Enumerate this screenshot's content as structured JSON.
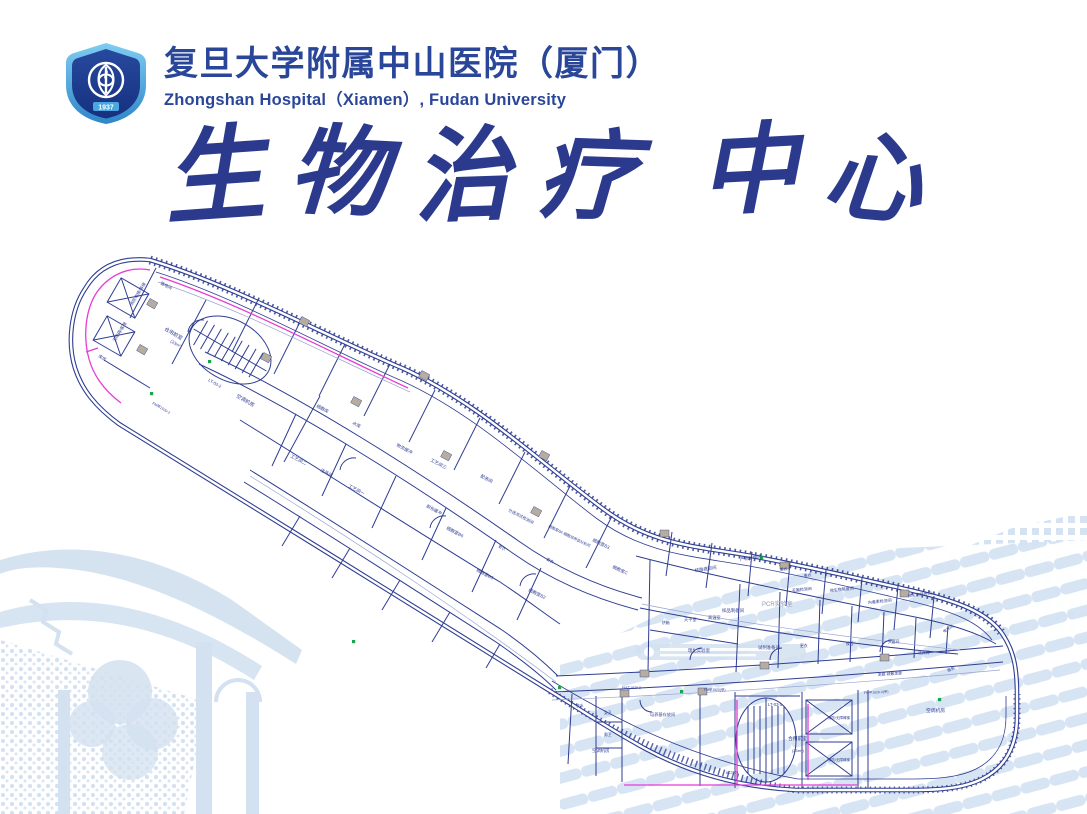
{
  "header": {
    "title_cn": "复旦大学附属中山医院（厦门）",
    "title_en": "Zhongshan Hospital（Xiamen）, Fudan University",
    "logo_year": "1937"
  },
  "main_title": "生物治疗中心",
  "colors": {
    "navy": "#2b3a8c",
    "headerblue": "#2a4699",
    "planline": "#2f3d92",
    "planlight": "#98a4cf",
    "magenta": "#e83bd6",
    "green": "#17a649",
    "watermark": "#d3e1f0",
    "doorgray": "#b6ad9e"
  },
  "floorplan": {
    "labels": [
      {
        "t": "强电间",
        "x": 160,
        "y": 284,
        "a": 28,
        "s": 4.2
      },
      {
        "t": "消防电梯/客梯",
        "x": 132,
        "y": 306,
        "a": -58,
        "s": 4.2
      },
      {
        "t": "无障碍/客梯",
        "x": 115,
        "y": 342,
        "a": -58,
        "s": 4.2
      },
      {
        "t": "库房",
        "x": 98,
        "y": 357,
        "a": 30,
        "s": 4.2
      },
      {
        "t": "合用前室",
        "x": 164,
        "y": 330,
        "a": 30,
        "s": 5
      },
      {
        "t": "(23m²)",
        "x": 170,
        "y": 342,
        "a": 30,
        "s": 4.2
      },
      {
        "t": "LT-03-2",
        "x": 208,
        "y": 381,
        "a": 30,
        "s": 4.2
      },
      {
        "t": "FM甲1520-2",
        "x": 152,
        "y": 404,
        "a": 30,
        "s": 3.6
      },
      {
        "t": "空调机房",
        "x": 236,
        "y": 397,
        "a": 30,
        "s": 5
      },
      {
        "t": "细胞库",
        "x": 316,
        "y": 407,
        "a": 28,
        "s": 4.4
      },
      {
        "t": "水库",
        "x": 352,
        "y": 424,
        "a": 28,
        "s": 4.4
      },
      {
        "t": "工艺间二",
        "x": 290,
        "y": 457,
        "a": 28,
        "s": 4.4
      },
      {
        "t": "洁具间",
        "x": 320,
        "y": 471,
        "a": 28,
        "s": 4.4
      },
      {
        "t": "工艺间一",
        "x": 348,
        "y": 487,
        "a": 28,
        "s": 4.4
      },
      {
        "t": "物流缓冲",
        "x": 396,
        "y": 446,
        "a": 28,
        "s": 4.4
      },
      {
        "t": "工艺间三",
        "x": 430,
        "y": 461,
        "a": 28,
        "s": 4.4
      },
      {
        "t": "配液间",
        "x": 480,
        "y": 477,
        "a": 28,
        "s": 4.4
      },
      {
        "t": "脱包缓冲",
        "x": 426,
        "y": 507,
        "a": 28,
        "s": 4.2
      },
      {
        "t": "细胞室B6",
        "x": 446,
        "y": 529,
        "a": 28,
        "s": 4.4
      },
      {
        "t": "细胞室B5",
        "x": 476,
        "y": 571,
        "a": 28,
        "s": 4.4
      },
      {
        "t": "分选流式检测间",
        "x": 508,
        "y": 511,
        "a": 28,
        "s": 4
      },
      {
        "t": "细胞室B4·细胞培养皿分析间",
        "x": 548,
        "y": 527,
        "a": 26,
        "s": 3.7
      },
      {
        "t": "细胞室B3",
        "x": 592,
        "y": 541,
        "a": 26,
        "s": 4.4
      },
      {
        "t": "细胞室B2",
        "x": 528,
        "y": 591,
        "a": 26,
        "s": 4.4
      },
      {
        "t": "细胞室C",
        "x": 612,
        "y": 568,
        "a": 24,
        "s": 4.4
      },
      {
        "t": "更衣",
        "x": 498,
        "y": 547,
        "a": 28,
        "s": 3.8
      },
      {
        "t": "更衣",
        "x": 546,
        "y": 560,
        "a": 28,
        "s": 3.8
      },
      {
        "t": "核酸提取间",
        "x": 695,
        "y": 572,
        "a": -8,
        "s": 4.4
      },
      {
        "t": "产物扩增间",
        "x": 740,
        "y": 561,
        "a": -8,
        "s": 4.4
      },
      {
        "t": "PCR实验室",
        "x": 762,
        "y": 606,
        "a": 0,
        "s": 6,
        "c": "#8d96ba"
      },
      {
        "t": "样品制备间",
        "x": 722,
        "y": 612,
        "a": 0,
        "s": 4.4
      },
      {
        "t": "更衣",
        "x": 780,
        "y": 571,
        "a": -6,
        "s": 3.8
      },
      {
        "t": "更衣",
        "x": 804,
        "y": 577,
        "a": -6,
        "s": 3.8
      },
      {
        "t": "无菌检测间",
        "x": 792,
        "y": 592,
        "a": -6,
        "s": 4
      },
      {
        "t": "微生物限度间",
        "x": 830,
        "y": 592,
        "a": -6,
        "s": 4
      },
      {
        "t": "内毒素检测间",
        "x": 868,
        "y": 604,
        "a": -6,
        "s": 4
      },
      {
        "t": "微生物培养间",
        "x": 908,
        "y": 597,
        "a": -6,
        "s": 4
      },
      {
        "t": "烘箱",
        "x": 662,
        "y": 624,
        "a": 0,
        "s": 3.8
      },
      {
        "t": "天平室",
        "x": 684,
        "y": 621,
        "a": 0,
        "s": 4.2
      },
      {
        "t": "高温室",
        "x": 708,
        "y": 619,
        "a": 0,
        "s": 4.2
      },
      {
        "t": "理化实验室",
        "x": 688,
        "y": 652,
        "a": 0,
        "s": 4.4
      },
      {
        "t": "试剂准备间",
        "x": 758,
        "y": 649,
        "a": 0,
        "s": 4.4
      },
      {
        "t": "更衣",
        "x": 800,
        "y": 647,
        "a": 0,
        "s": 3.8
      },
      {
        "t": "候检",
        "x": 846,
        "y": 645,
        "a": 0,
        "s": 3.8
      },
      {
        "t": "灭菌间",
        "x": 888,
        "y": 643,
        "a": 0,
        "s": 3.8
      },
      {
        "t": "洁具间",
        "x": 918,
        "y": 654,
        "a": 0,
        "s": 3.8
      },
      {
        "t": "电井间",
        "x": 944,
        "y": 633,
        "a": -32,
        "s": 3.8
      },
      {
        "t": "走廊·疏散走廊",
        "x": 878,
        "y": 676,
        "a": -4,
        "s": 3.8
      },
      {
        "t": "服务",
        "x": 948,
        "y": 672,
        "a": -24,
        "s": 3.8
      },
      {
        "t": "茶水",
        "x": 576,
        "y": 707,
        "a": 0,
        "s": 3.8
      },
      {
        "t": "女卫",
        "x": 604,
        "y": 714,
        "a": 0,
        "s": 3.8
      },
      {
        "t": "男卫",
        "x": 604,
        "y": 736,
        "a": 0,
        "s": 3.8
      },
      {
        "t": "培养基存放间",
        "x": 650,
        "y": 716,
        "a": 0,
        "s": 4.2
      },
      {
        "t": "空调机房",
        "x": 592,
        "y": 752,
        "a": 0,
        "s": 4.4
      },
      {
        "t": "FM乙1520-2",
        "x": 622,
        "y": 689,
        "a": 0,
        "s": 3.4
      },
      {
        "t": "FM甲1520(甲)",
        "x": 704,
        "y": 691,
        "a": 0,
        "s": 3.4
      },
      {
        "t": "FM甲1520-3(甲)",
        "x": 864,
        "y": 694,
        "a": -3,
        "s": 3.4
      },
      {
        "t": "LT-03-1",
        "x": 768,
        "y": 706,
        "a": 0,
        "s": 4.2
      },
      {
        "t": "合用前室",
        "x": 788,
        "y": 740,
        "a": 0,
        "s": 4.8
      },
      {
        "t": "(25m²)",
        "x": 792,
        "y": 752,
        "a": 0,
        "s": 4
      },
      {
        "t": "消防/无障碍梯",
        "x": 828,
        "y": 719,
        "a": 0,
        "s": 3.5
      },
      {
        "t": "消防/无障碍梯",
        "x": 828,
        "y": 761,
        "a": 0,
        "s": 3.5
      },
      {
        "t": "空调机房",
        "x": 926,
        "y": 712,
        "a": 0,
        "s": 4.8
      },
      {
        "t": "BC3724",
        "x": 726,
        "y": 774,
        "a": -4,
        "s": 3.4
      }
    ]
  }
}
